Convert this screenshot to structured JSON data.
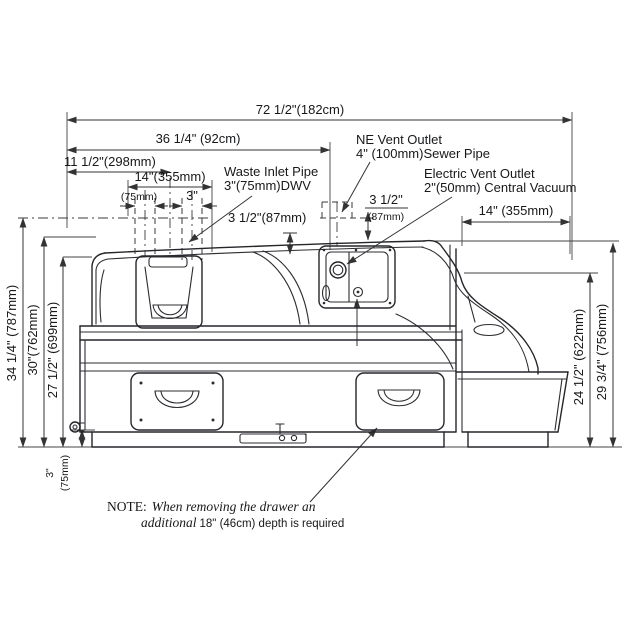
{
  "diagram": {
    "dims": {
      "overall_width": "72 1/2\"(182cm)",
      "width_36": "36 1/4\" (92cm)",
      "width_11half": "11 1/2\"(298mm)",
      "width_14_left": "14\"(355mm)",
      "pipe_75mm": "(75mm)",
      "pipe_3in": "3\"",
      "waste_clearance": "3 1/2\"(87mm)",
      "vent_clearance_top": "3 1/2\"",
      "vent_clearance_bottom": "(87mm)",
      "width_14_right": "14\" (355mm)",
      "height_34": "34 1/4\" (787mm)",
      "height_30": "30\"(762mm)",
      "height_27": "27 1/2\" (699mm)",
      "height_3_a": "3\"",
      "height_3_b": "(75mm)",
      "height_24": "24 1/2\" (622mm)",
      "height_29": "29 3/4\" (756mm)"
    },
    "labels": {
      "waste_inlet_1": "Waste Inlet Pipe",
      "waste_inlet_2": "3\"(75mm)DWV",
      "ne_vent_1": "NE Vent Outlet",
      "ne_vent_2": "4\" (100mm)Sewer Pipe",
      "electric_vent_1": "Electric Vent Outlet",
      "electric_vent_2": "2\"(50mm) Central Vacuum"
    },
    "note": {
      "prefix": "NOTE:",
      "line1": "When removing the drawer an",
      "line2_italic": "additional",
      "line2_rest": "18\" (46cm) depth is required"
    },
    "colors": {
      "line": "#25262a",
      "background": "#ffffff"
    }
  }
}
